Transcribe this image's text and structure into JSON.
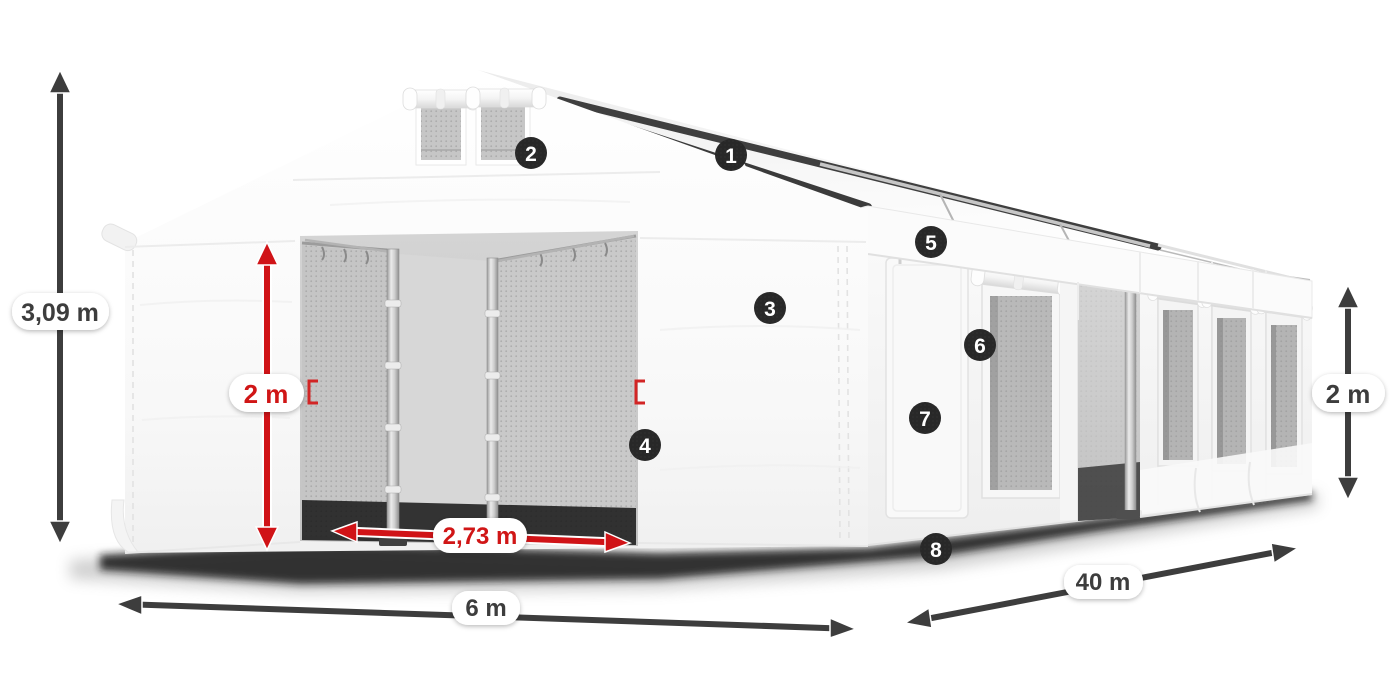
{
  "figure": {
    "title": "Tent dimensions diagram",
    "description": "White PVC marquee storage tent shown in perspective with dimension arrows and numbered feature callouts"
  },
  "dimensions": {
    "total_height": "3,09 m",
    "entrance_height": "2 m",
    "entrance_width": "2,73 m",
    "width": "6 m",
    "length": "40 m",
    "side_wall_height": "2 m"
  },
  "callouts": [
    "1",
    "2",
    "3",
    "4",
    "5",
    "6",
    "7",
    "8"
  ],
  "colors": {
    "dimension_dark": "#3d3d3d",
    "dimension_red": "#d01317",
    "callout_background": "#282828",
    "tent_white": "#f7f7f7",
    "mesh_gray": "#c0c0c0"
  }
}
